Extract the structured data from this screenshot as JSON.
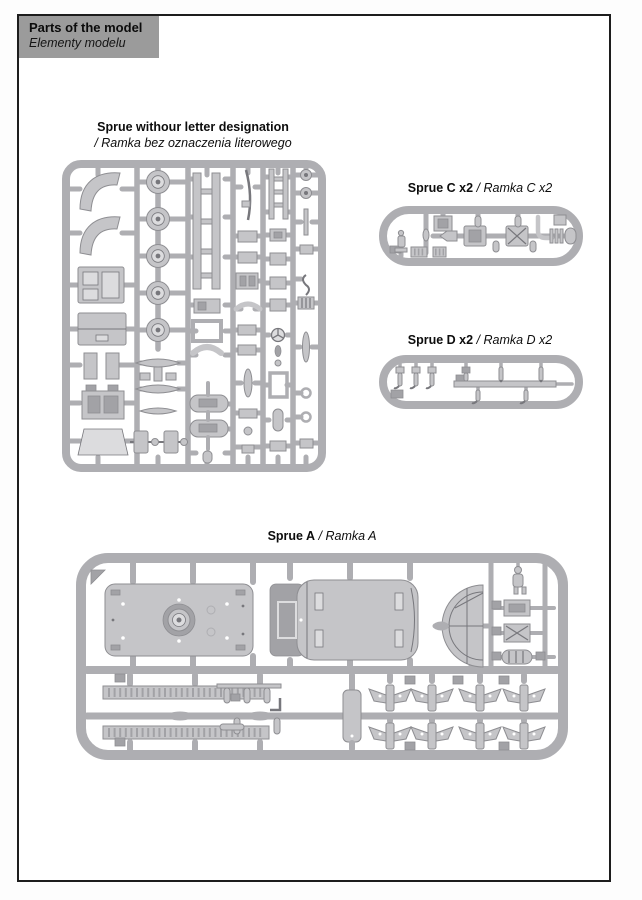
{
  "page": {
    "background": "#fdfdfd",
    "border_color": "#1d1d1d"
  },
  "header": {
    "title": "Parts of the model",
    "subtitle": "Elementy modelu",
    "background": "#9b9b9b"
  },
  "colors": {
    "sprue": "#aeaeb2",
    "sprue_dark": "#8e8e92",
    "part": "#c5c5c8",
    "part_light": "#dcdcde",
    "part_dark": "#a2a2a6",
    "detail": "#77777c"
  },
  "sections": {
    "no_letter": {
      "title": "Sprue withour letter designation",
      "subtitle": "/ Ramka bez oznaczenia literowego"
    },
    "sprue_c": {
      "title": "Sprue C x2",
      "subtitle": "/ Ramka C x2"
    },
    "sprue_d": {
      "title": "Sprue D x2",
      "subtitle": "/ Ramka D x2"
    },
    "sprue_a": {
      "title": "Sprue A",
      "subtitle": "/ Ramka A"
    }
  }
}
